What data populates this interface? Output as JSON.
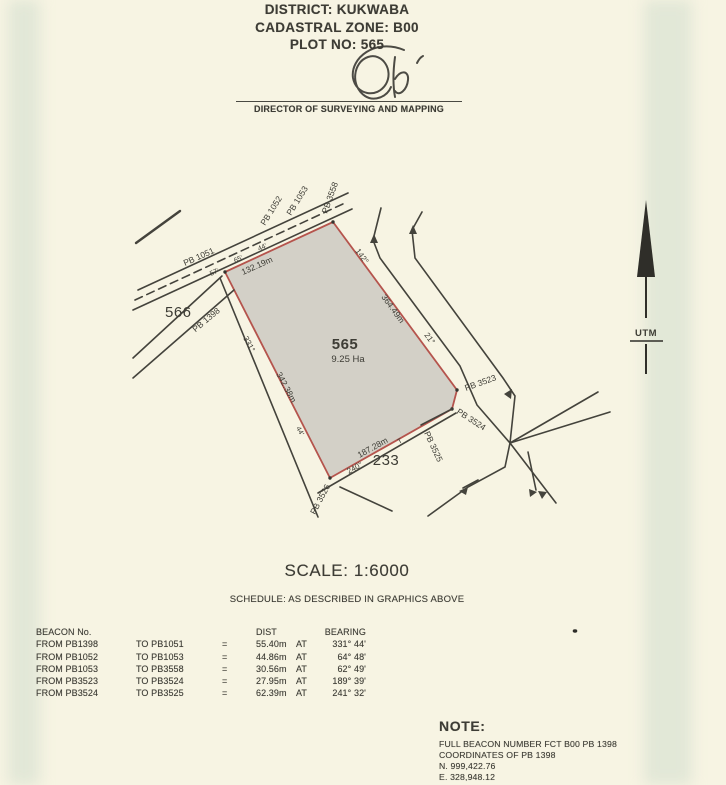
{
  "header": {
    "district": "DISTRICT: KUKWABA",
    "cadastral_zone": "CADASTRAL ZONE: B00",
    "plot_no": "PLOT NO: 565",
    "director_title": "DIRECTOR OF SURVEYING AND MAPPING"
  },
  "map": {
    "labels": {
      "pb1051": "PB 1051",
      "tick57": "57'",
      "tick65": "65'",
      "tick44_top": "44'",
      "dist_top": "132.19m",
      "pb1052": "PB 1052",
      "pb1053": "PB 1053",
      "pb3558": "PB 3558",
      "brg142": "142°",
      "dist_east": "364.49m",
      "brg21": "21°",
      "plot566": "566",
      "pb1398": "PB 1398",
      "brg331": "331°",
      "dist_west": "342.38m",
      "tick44_west": "44'",
      "plot565": "565",
      "area565": "9.25 Ha",
      "pb3523": "PB 3523",
      "pb3524": "PB 3524",
      "pb3525": "PB 3525",
      "dist_south": "187.28m",
      "tick_t": "T",
      "brg240": "240°",
      "plot233": "233",
      "pb3526": "PB 3526",
      "utm": "UTM"
    }
  },
  "scale_text": "SCALE: 1:6000",
  "schedule_caption": "SCHEDULE: AS DESCRIBED IN GRAPHICS ABOVE",
  "table": {
    "headers": {
      "beacon": "BEACON No.",
      "dist": "DIST",
      "bearing": "BEARING"
    },
    "rows": [
      {
        "from": "FROM PB1398",
        "to": "TO PB1051",
        "eq": "=",
        "dist": "55.40m",
        "at": "AT",
        "bearing": "331° 44'"
      },
      {
        "from": "FROM PB1052",
        "to": "TO PB1053",
        "eq": "=",
        "dist": "44.86m",
        "at": "AT",
        "bearing": "64° 48'"
      },
      {
        "from": "FROM PB1053",
        "to": "TO PB3558",
        "eq": "=",
        "dist": "30.56m",
        "at": "AT",
        "bearing": "62° 49'"
      },
      {
        "from": "FROM PB3523",
        "to": "TO PB3524",
        "eq": "=",
        "dist": "27.95m",
        "at": "AT",
        "bearing": "189° 39'"
      },
      {
        "from": "FROM PB3524",
        "to": "TO PB3525",
        "eq": "=",
        "dist": "62.39m",
        "at": "AT",
        "bearing": "241° 32'"
      }
    ]
  },
  "note": {
    "title": "NOTE:",
    "lines": [
      "FULL BEACON NUMBER FCT B00 PB 1398",
      "COORDINATES OF PB 1398",
      "N. 999,422.76",
      "E. 328,948.12"
    ]
  },
  "colors": {
    "paper": "#f7f4e3",
    "ink": "#3d3c35",
    "boundary_red": "#b5544d",
    "plot_fill": "#d3d0c7",
    "scan_band": "#dfe5da"
  }
}
